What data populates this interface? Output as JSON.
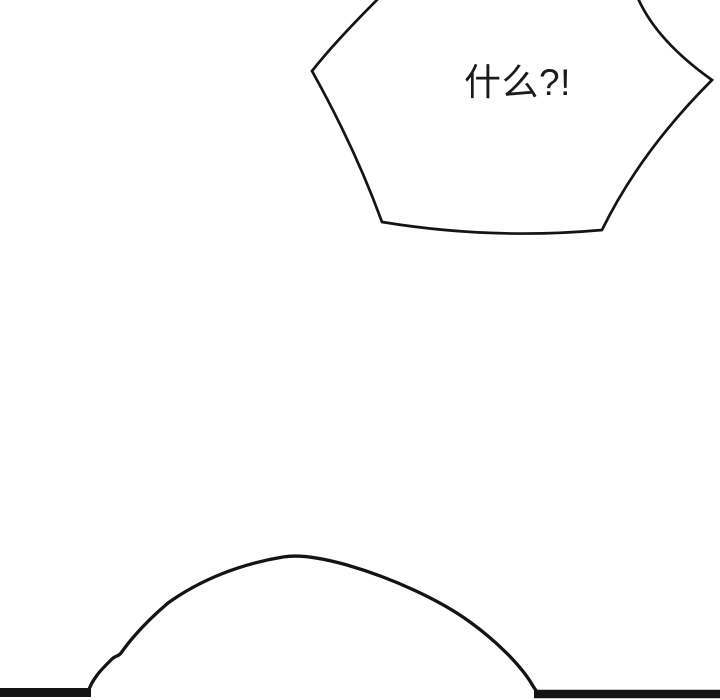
{
  "speech_bubble": {
    "text": "什么?!",
    "shape": "spiky-shout-bubble",
    "fill": "#ffffff"
  },
  "colors": {
    "background": "#ffffff",
    "ink": "#141414"
  },
  "scene": {
    "bottom_shapes": [
      "hill-curve",
      "ground-line-left",
      "ground-line-right"
    ]
  }
}
